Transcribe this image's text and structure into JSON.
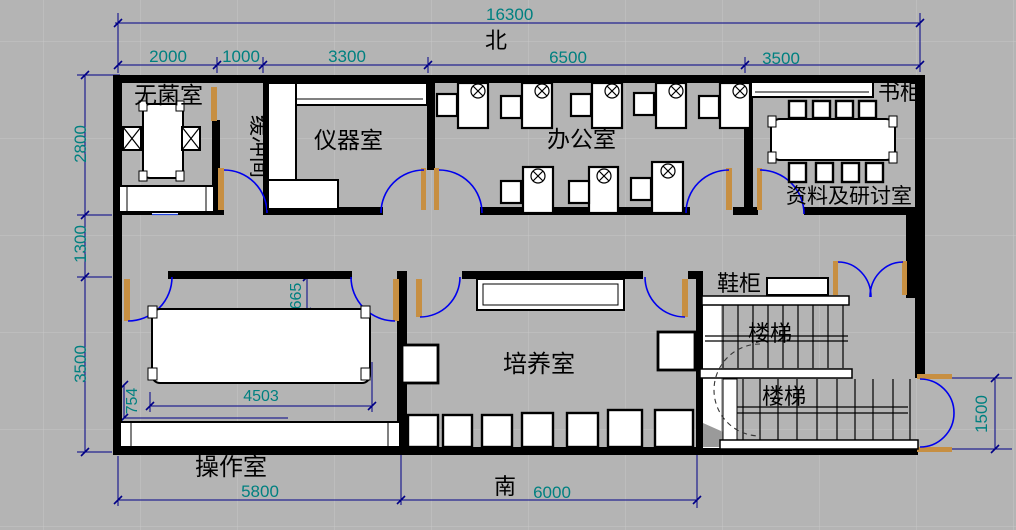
{
  "plan_title": "Laboratory floor plan",
  "orientation": {
    "north": "北",
    "south": "南"
  },
  "rooms": {
    "sterile": "无菌室",
    "buffer": "缓冲间",
    "instrument": "仪器室",
    "office": "办公室",
    "archive": "资料及研讨室",
    "culture": "培养室",
    "operation": "操作室",
    "stairs_upper": "楼梯",
    "stairs_lower": "楼梯"
  },
  "fixtures": {
    "bookcase": "书柜",
    "shoe_cabinet": "鞋柜"
  },
  "dimensions": {
    "total_width": "16300",
    "top": [
      "2000",
      "1000",
      "3300",
      "6500",
      "3500"
    ],
    "left": [
      "2800",
      "1300",
      "3500"
    ],
    "bottom": [
      "5800",
      "6000"
    ],
    "right": [
      "1500"
    ],
    "interior": {
      "op_width": "4503",
      "op_offset": "754",
      "door": "665"
    }
  },
  "colors": {
    "background": "#b4b4b4",
    "grid": "#c6c6c6",
    "wall": "#000000",
    "dim_line": "#000087",
    "dim_text": "#008080",
    "door_arc": "#0000ee",
    "door_leaf": "#c78f42",
    "label": "#000000"
  }
}
